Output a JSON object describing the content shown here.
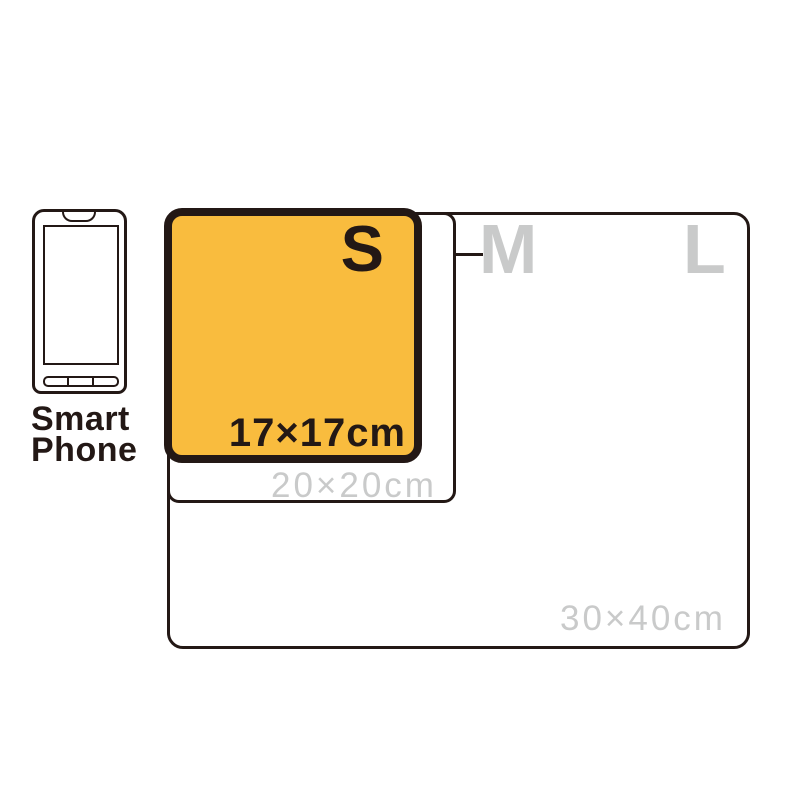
{
  "diagram": {
    "type": "product-size-comparison",
    "colors": {
      "outline": "#231815",
      "highlight_fill": "#F9BC3E",
      "muted_text": "#C9CACA",
      "background": "#FFFFFF"
    },
    "reference_object": {
      "icon": "smartphone-icon",
      "label_line1": "Smart",
      "label_line2": "Phone"
    },
    "sizes": {
      "s": {
        "label": "S",
        "dimensions": "17×17cm",
        "highlighted": true
      },
      "m": {
        "label": "M",
        "dimensions": "20×20cm",
        "highlighted": false
      },
      "l": {
        "label": "L",
        "dimensions": "30×40cm",
        "highlighted": false
      }
    }
  }
}
